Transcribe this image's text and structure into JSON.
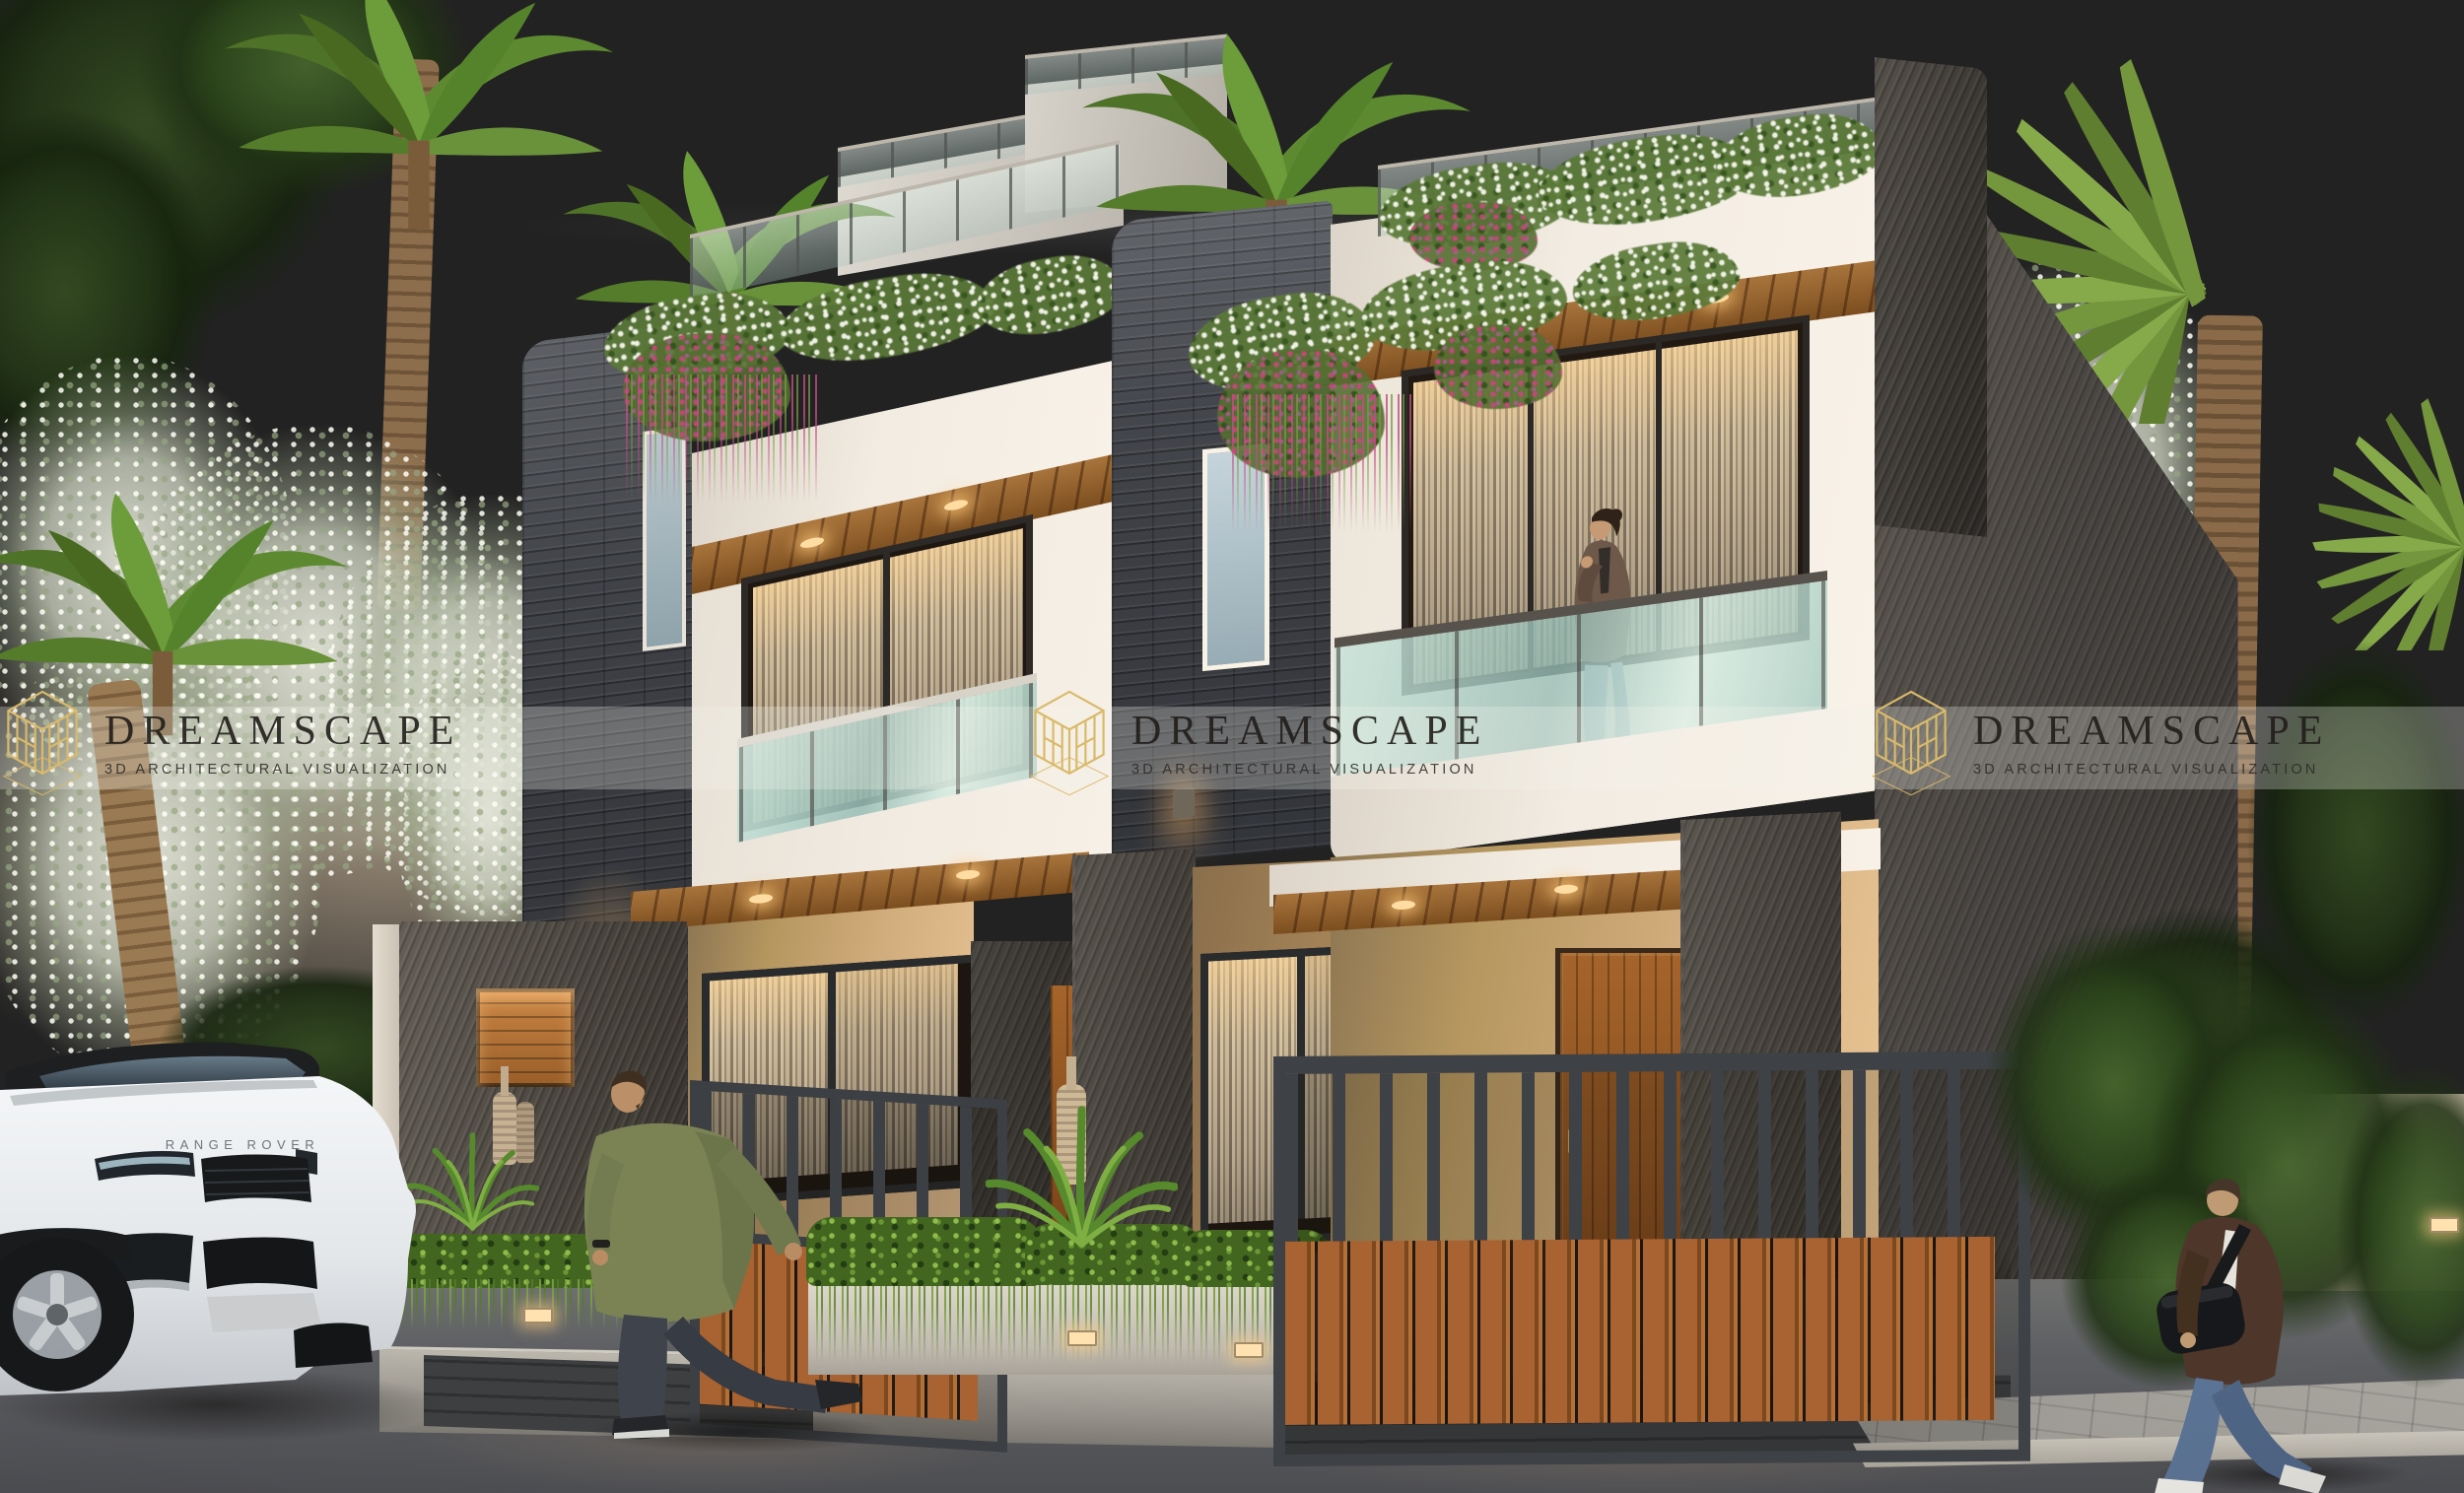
{
  "watermark": {
    "brand": "DREAMSCAPE",
    "tagline": "3D ARCHITECTURAL VISUALIZATION",
    "logo_icon": "hexagon-cube-wireframe",
    "logo_color": "#d9ba6a",
    "title_color": "#24211e",
    "band_color": "rgba(246,243,238,0.28)",
    "instances": "3"
  },
  "vehicle": {
    "hood_text": "RANGE ROVER",
    "body_color": "#edeff1",
    "type": "white-luxury-suv"
  },
  "scene": {
    "time": "dusk",
    "subject": "modern twin duplex villa exterior render",
    "people_count": "3",
    "palette": {
      "sky_top": "#7d8497",
      "sky_horizon": "#e4d2bd",
      "ledgestone": "#3e4045",
      "white_plaster": "#f1ebe1",
      "beige_stucco": "#c9a87b",
      "dark_stucco": "#4a453f",
      "wood": "#9a6430",
      "railing_glass": "#aecfc6",
      "foliage": "#567f2b",
      "asphalt": "#595a5e"
    }
  }
}
